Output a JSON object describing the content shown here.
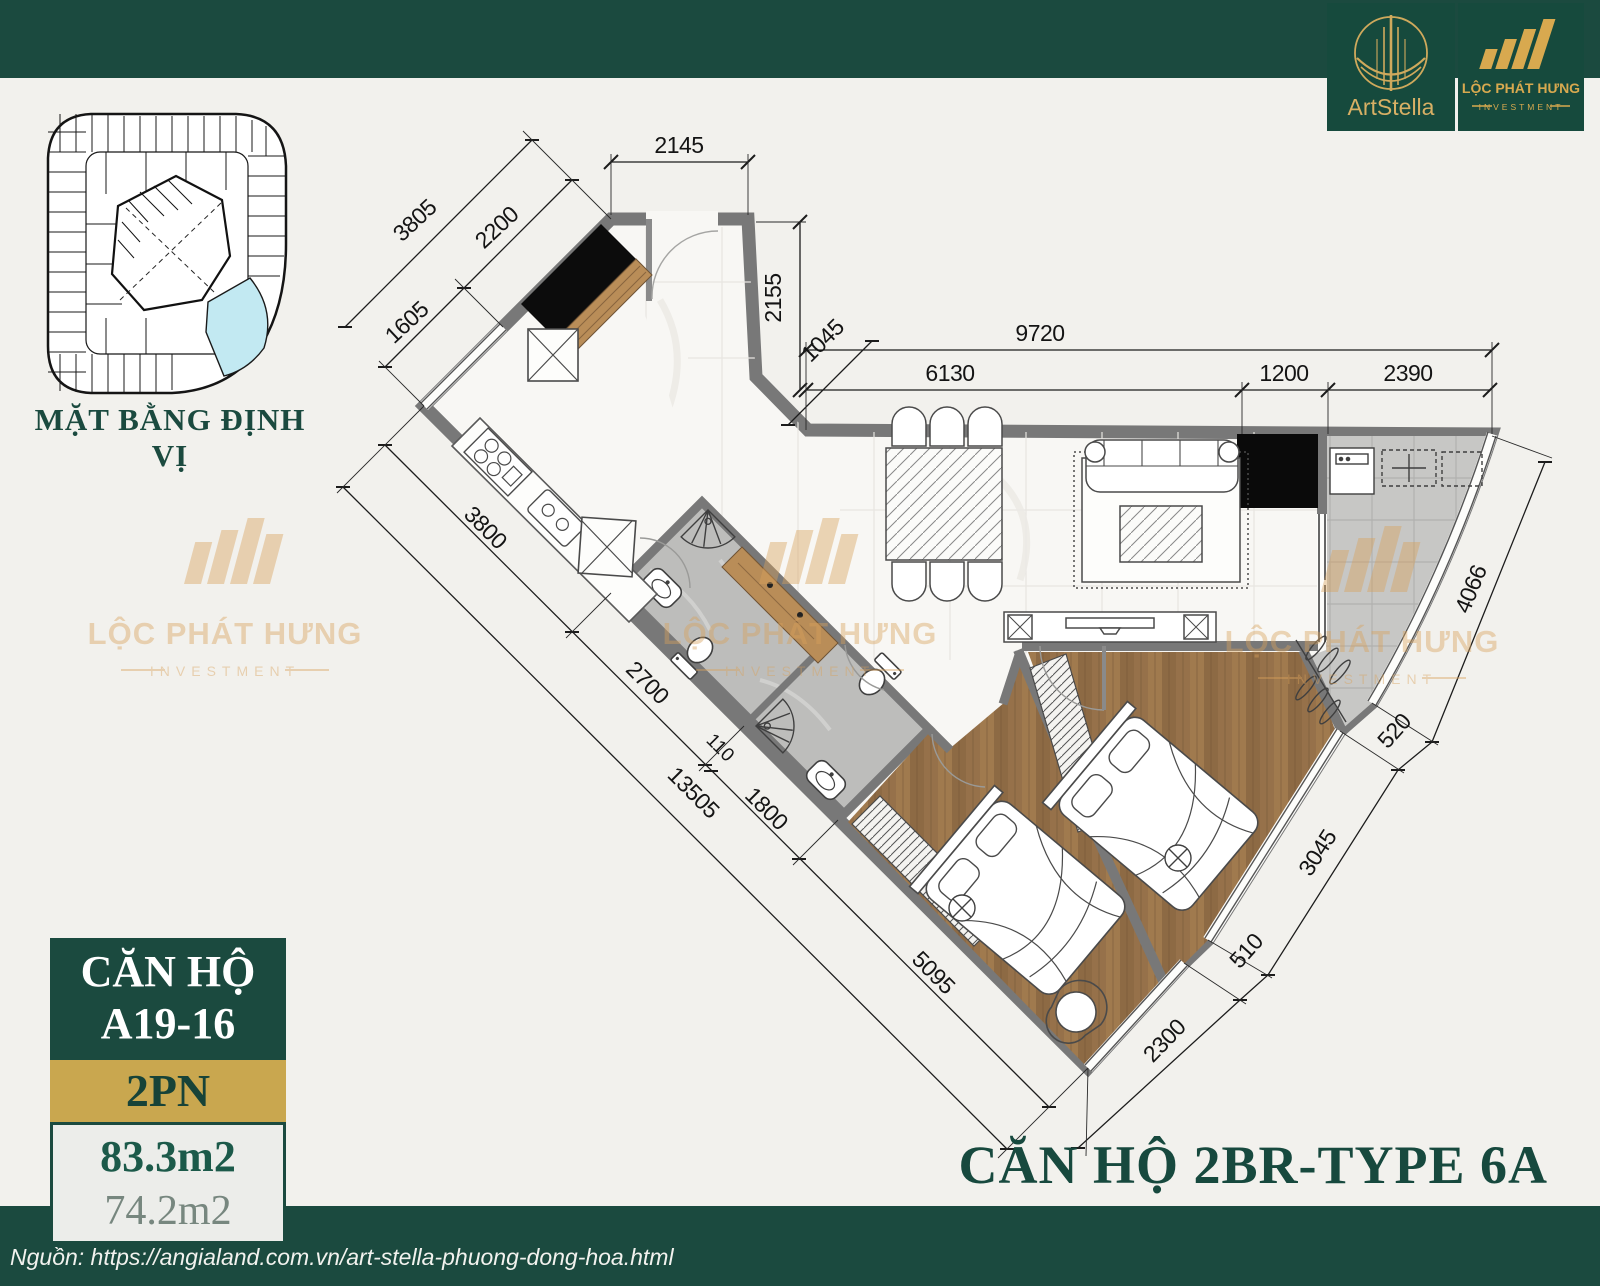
{
  "logos": {
    "artstella": {
      "name": "ArtStella"
    },
    "lph": {
      "line1": "LỘC PHÁT HƯNG",
      "line2": "INVESTMENT"
    }
  },
  "site_plan": {
    "caption": "MẶT BẰNG ĐỊNH VỊ",
    "highlight_color": "#c2e9f2"
  },
  "info_card": {
    "line1": "CĂN HỘ",
    "line2": "A19-16",
    "bedrooms": "2PN",
    "area_gross": "83.3m2",
    "area_net": "74.2m2"
  },
  "plan_title": "CĂN HỘ 2BR-TYPE 6A",
  "source": "Nguồn: https://angialand.com.vn/art-stella-phuong-dong-hoa.html",
  "watermark": {
    "text": "LỘC PHÁT HƯNG",
    "sub": "INVESTMENT"
  },
  "colors": {
    "brand_green": "#1b4a3f",
    "brand_gold": "#c9a74f",
    "watermark_gold": "#d9a25c",
    "wall_gray": "#787878",
    "bath_tile": "#bdbdbb",
    "balcony_tile": "#c7c7c5",
    "wood_floor": "#a07a4e",
    "highlight_cyan": "#c2e9f2"
  },
  "dimensions": {
    "d2145": "2145",
    "d3805": "3805",
    "d2200": "2200",
    "d1605": "1605",
    "d2155": "2155",
    "d1045": "1045",
    "d9720": "9720",
    "d6130": "6130",
    "d1200": "1200",
    "d2390": "2390",
    "d3800": "3800",
    "d2700": "2700",
    "d110": "110",
    "d1800": "1800",
    "d13505": "13505",
    "d5095": "5095",
    "d4066": "4066",
    "d520": "520",
    "d3045": "3045",
    "d510": "510",
    "d2300": "2300"
  }
}
